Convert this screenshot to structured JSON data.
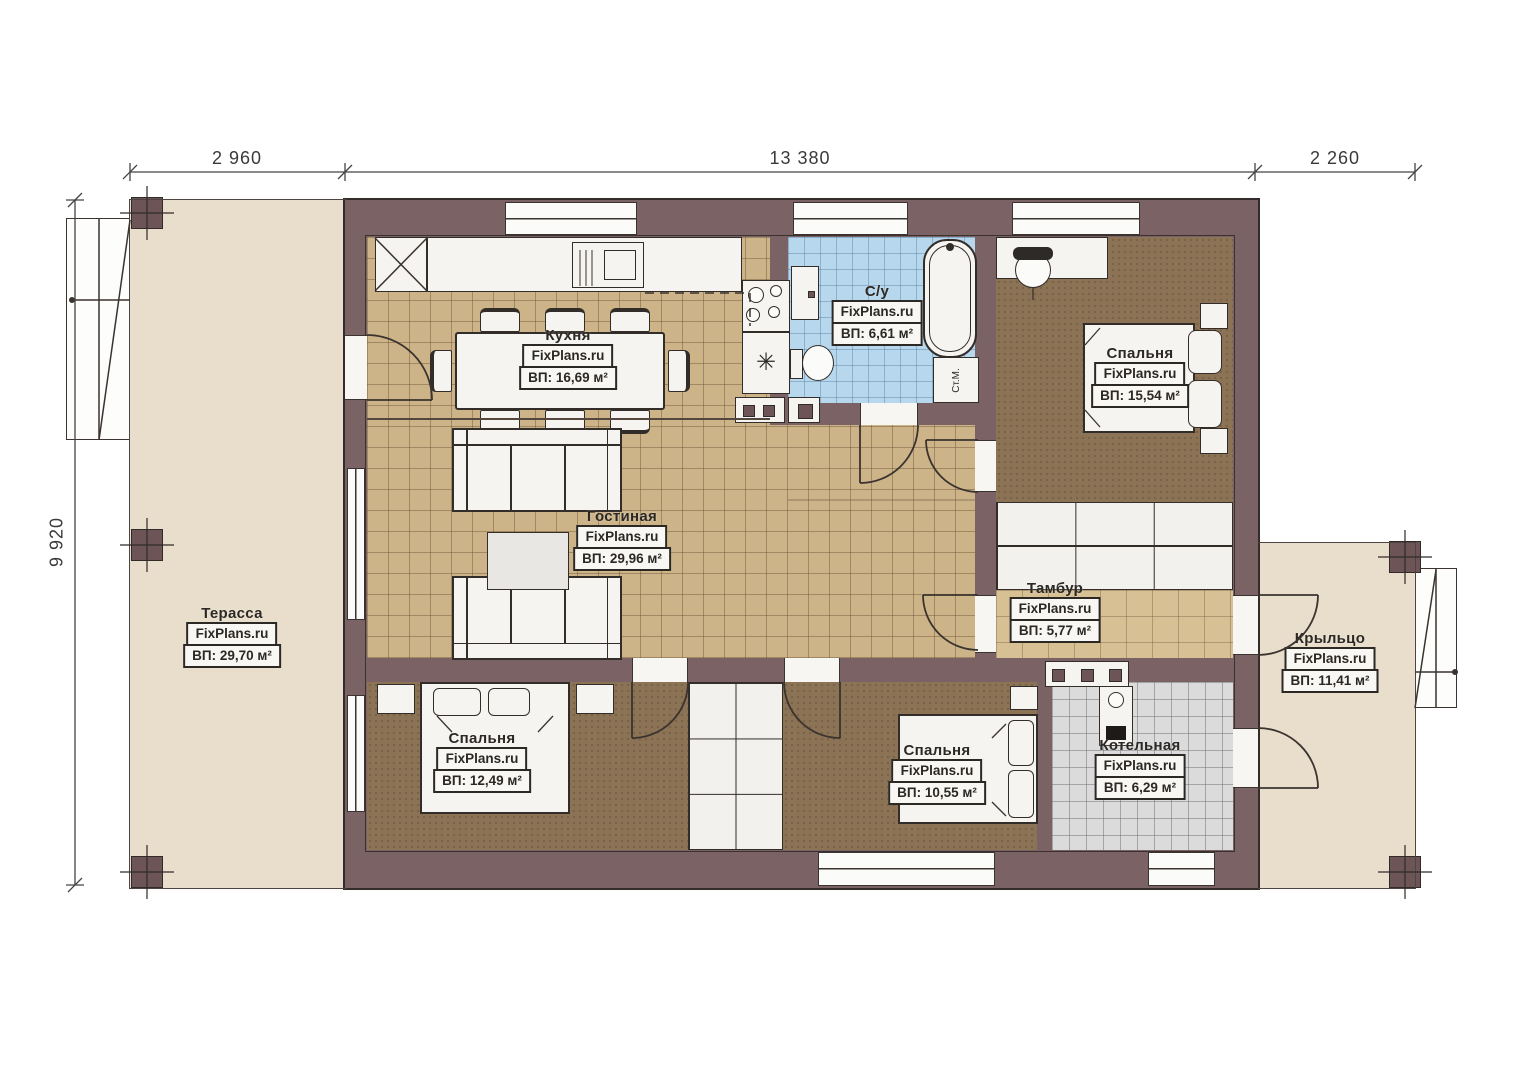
{
  "plan": {
    "brand": "FixPlans.ru",
    "dimensions": {
      "width_left": "2 960",
      "width_center": "13 380",
      "width_right": "2 260",
      "height": "9 920"
    },
    "rooms": {
      "terrace": {
        "name": "Терасса",
        "area": "ВП: 29,70 м²"
      },
      "kitchen": {
        "name": "Кухня",
        "area": "ВП: 16,69 м²"
      },
      "bathroom": {
        "name": "С/у",
        "area": "ВП: 6,61 м²"
      },
      "bedroom_master": {
        "name": "Спальня",
        "area": "ВП: 15,54 м²"
      },
      "living": {
        "name": "Гостиная",
        "area": "ВП: 29,96 м²"
      },
      "vestibule": {
        "name": "Тамбур",
        "area": "ВП: 5,77 м²"
      },
      "porch": {
        "name": "Крыльцо",
        "area": "ВП: 11,41 м²"
      },
      "bedroom_left": {
        "name": "Спальня",
        "area": "ВП: 12,49 м²"
      },
      "bedroom_mid": {
        "name": "Спальня",
        "area": "ВП: 10,55 м²"
      },
      "boiler": {
        "name": "Котельная",
        "area": "ВП: 6,29 м²"
      }
    },
    "labels": {
      "washing_machine": "Ст.М."
    },
    "icons": {
      "fridge": "✳"
    },
    "colors": {
      "wall": "#7b6264",
      "deck": "#e8decb",
      "floor_wood": "#cdb488",
      "floor_bedroom": "#8c7355",
      "floor_bath": "#b6d7ec",
      "floor_boiler": "#dbdbdc"
    }
  }
}
